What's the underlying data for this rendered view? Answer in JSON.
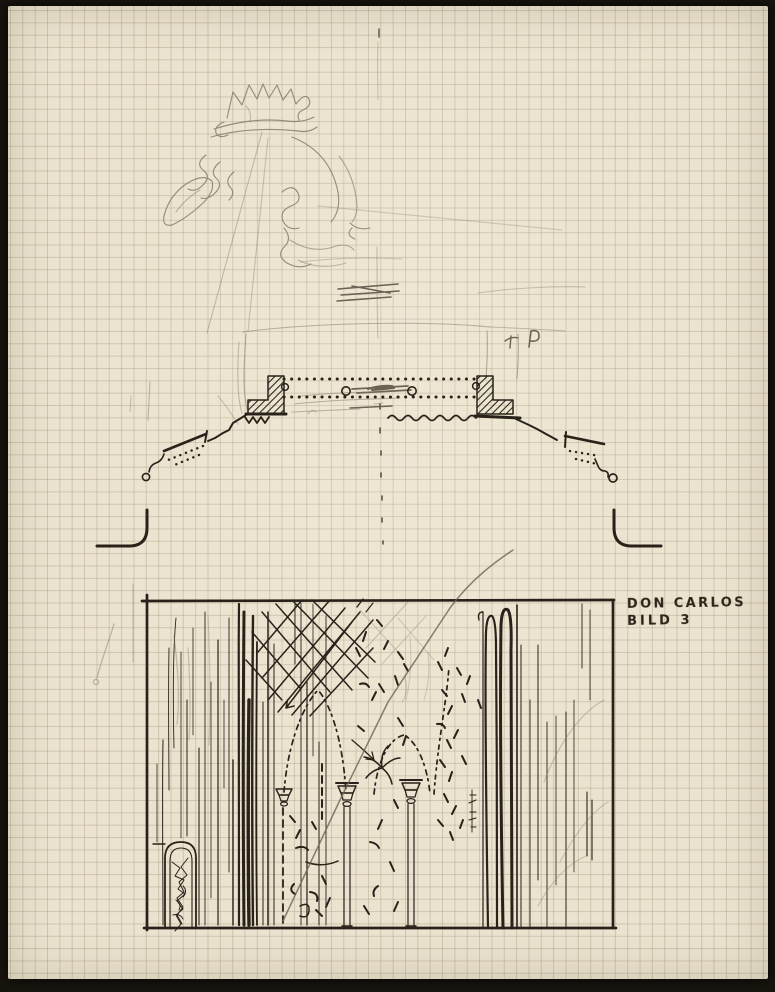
{
  "artwork": {
    "label": {
      "line1": "DON CARLOS",
      "line2": "BILD 3"
    }
  },
  "colors": {
    "background": "#18140e",
    "paper": "#ebe3cf",
    "grid_line": "#c9bfa9",
    "ink": "#29221a",
    "pencil": "#867d6a"
  }
}
